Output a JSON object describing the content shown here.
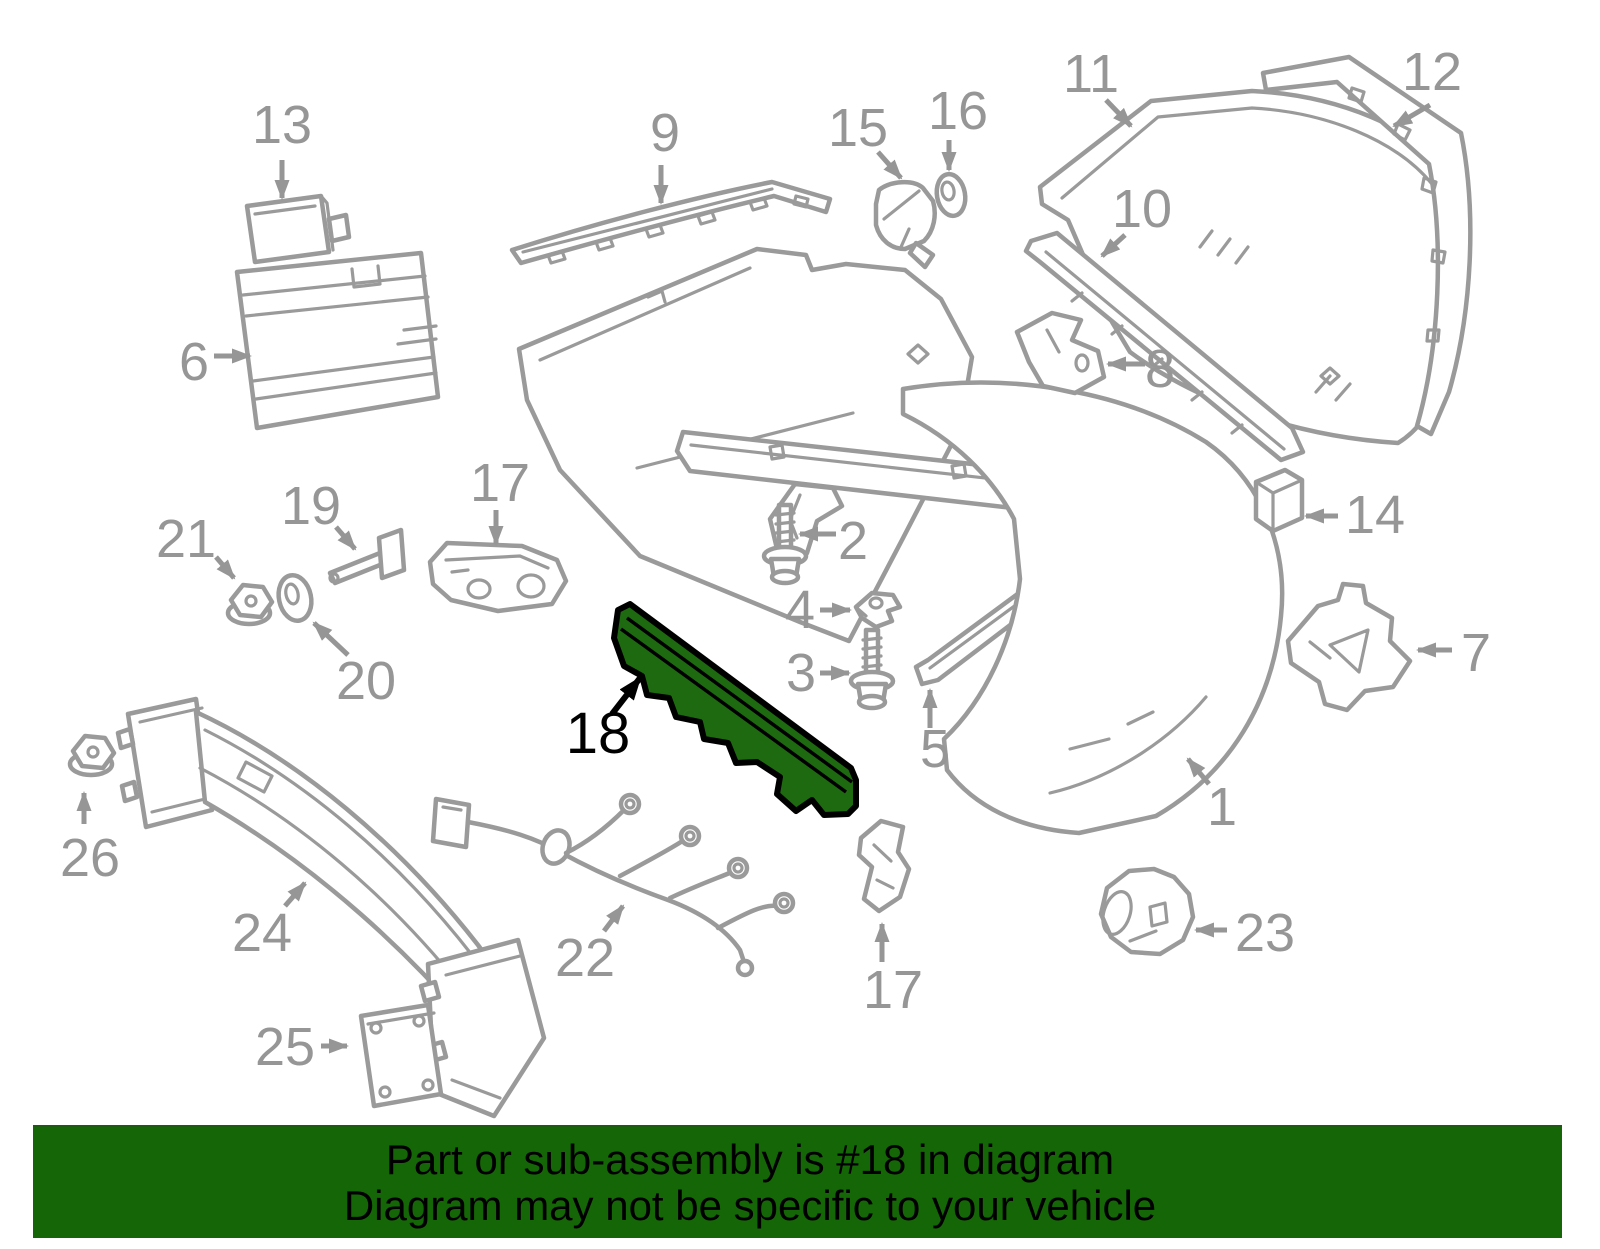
{
  "page": {
    "type": "exploded-parts-diagram",
    "subject": "rear bumper assembly"
  },
  "banner": {
    "line1": "Part or sub-assembly is #18 in diagram",
    "line2": "Diagram may not be specific to your vehicle",
    "background_color": "#156606",
    "text_color": "#000000"
  },
  "highlight": {
    "callout": "18",
    "fill_color": "#1E6A10",
    "outline_color": "#000000"
  },
  "diagram": {
    "line_color": "#9A9A9A",
    "label_color": "#969696",
    "callouts": {
      "c1": "1",
      "c2": "2",
      "c3": "3",
      "c4": "4",
      "c5": "5",
      "c6": "6",
      "c7": "7",
      "c8": "8",
      "c9": "9",
      "c10": "10",
      "c11": "11",
      "c12": "12",
      "c13": "13",
      "c14": "14",
      "c15": "15",
      "c16": "16",
      "c17_upper": "17",
      "c17_lower": "17",
      "c18": "18",
      "c19": "19",
      "c20": "20",
      "c21": "21",
      "c22": "22",
      "c23": "23",
      "c24": "24",
      "c25": "25",
      "c26": "26"
    }
  }
}
